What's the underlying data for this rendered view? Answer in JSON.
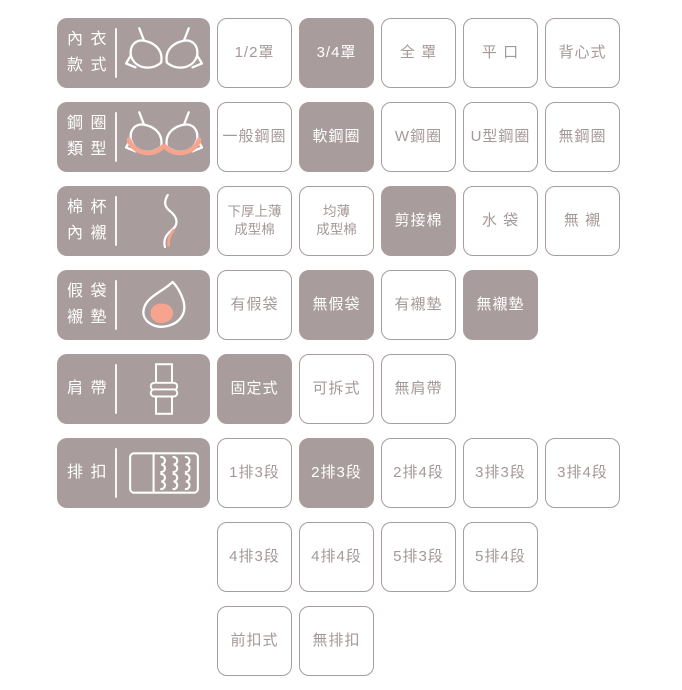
{
  "colors": {
    "accent_mauve": "#a89c9c",
    "accent_salmon": "#f6a48e",
    "option_text": "#a59898",
    "background": "#ffffff"
  },
  "groups": [
    {
      "label_lines": [
        "內 衣",
        "款 式"
      ],
      "icon": "bra-icon",
      "options": [
        {
          "text": "1/2罩",
          "selected": false
        },
        {
          "text": "3/4罩",
          "selected": true
        },
        {
          "text": "全 罩",
          "selected": false
        },
        {
          "text": "平 口",
          "selected": false
        },
        {
          "text": "背心式",
          "selected": false
        }
      ]
    },
    {
      "label_lines": [
        "鋼 圈",
        "類 型"
      ],
      "icon": "underwire-icon",
      "options": [
        {
          "text": "一般鋼圈",
          "selected": false
        },
        {
          "text": "軟鋼圈",
          "selected": true
        },
        {
          "text": "W鋼圈",
          "selected": false
        },
        {
          "text": "U型鋼圈",
          "selected": false
        },
        {
          "text": "無鋼圈",
          "selected": false
        }
      ]
    },
    {
      "label_lines": [
        "棉 杯",
        "內 襯"
      ],
      "icon": "cup-lining-icon",
      "options": [
        {
          "text": "下厚上薄",
          "text2": "成型棉",
          "selected": false
        },
        {
          "text": "均薄",
          "text2": "成型棉",
          "selected": false
        },
        {
          "text": "剪接棉",
          "selected": true
        },
        {
          "text": "水 袋",
          "selected": false
        },
        {
          "text": "無 襯",
          "selected": false
        }
      ]
    },
    {
      "label_lines": [
        "假 袋",
        "襯 墊"
      ],
      "icon": "pad-icon",
      "options": [
        {
          "text": "有假袋",
          "selected": false
        },
        {
          "text": "無假袋",
          "selected": true
        },
        {
          "text": "有襯墊",
          "selected": false
        },
        {
          "text": "無襯墊",
          "selected": true
        }
      ]
    },
    {
      "label_lines": [
        "肩 帶"
      ],
      "icon": "shoulder-strap-icon",
      "options": [
        {
          "text": "固定式",
          "selected": true
        },
        {
          "text": "可拆式",
          "selected": false
        },
        {
          "text": "無肩帶",
          "selected": false
        }
      ]
    },
    {
      "label_lines": [
        "排 扣"
      ],
      "icon": "hook-closure-icon",
      "options": [
        {
          "text": "1排3段",
          "selected": false
        },
        {
          "text": "2排3段",
          "selected": true
        },
        {
          "text": "2排4段",
          "selected": false
        },
        {
          "text": "3排3段",
          "selected": false
        },
        {
          "text": "3排4段",
          "selected": false
        }
      ],
      "options2": [
        {
          "text": "4排3段",
          "selected": false
        },
        {
          "text": "4排4段",
          "selected": false
        },
        {
          "text": "5排3段",
          "selected": false
        },
        {
          "text": "5排4段",
          "selected": false
        }
      ],
      "options3": [
        {
          "text": "前扣式",
          "selected": false
        },
        {
          "text": "無排扣",
          "selected": false
        }
      ]
    }
  ]
}
